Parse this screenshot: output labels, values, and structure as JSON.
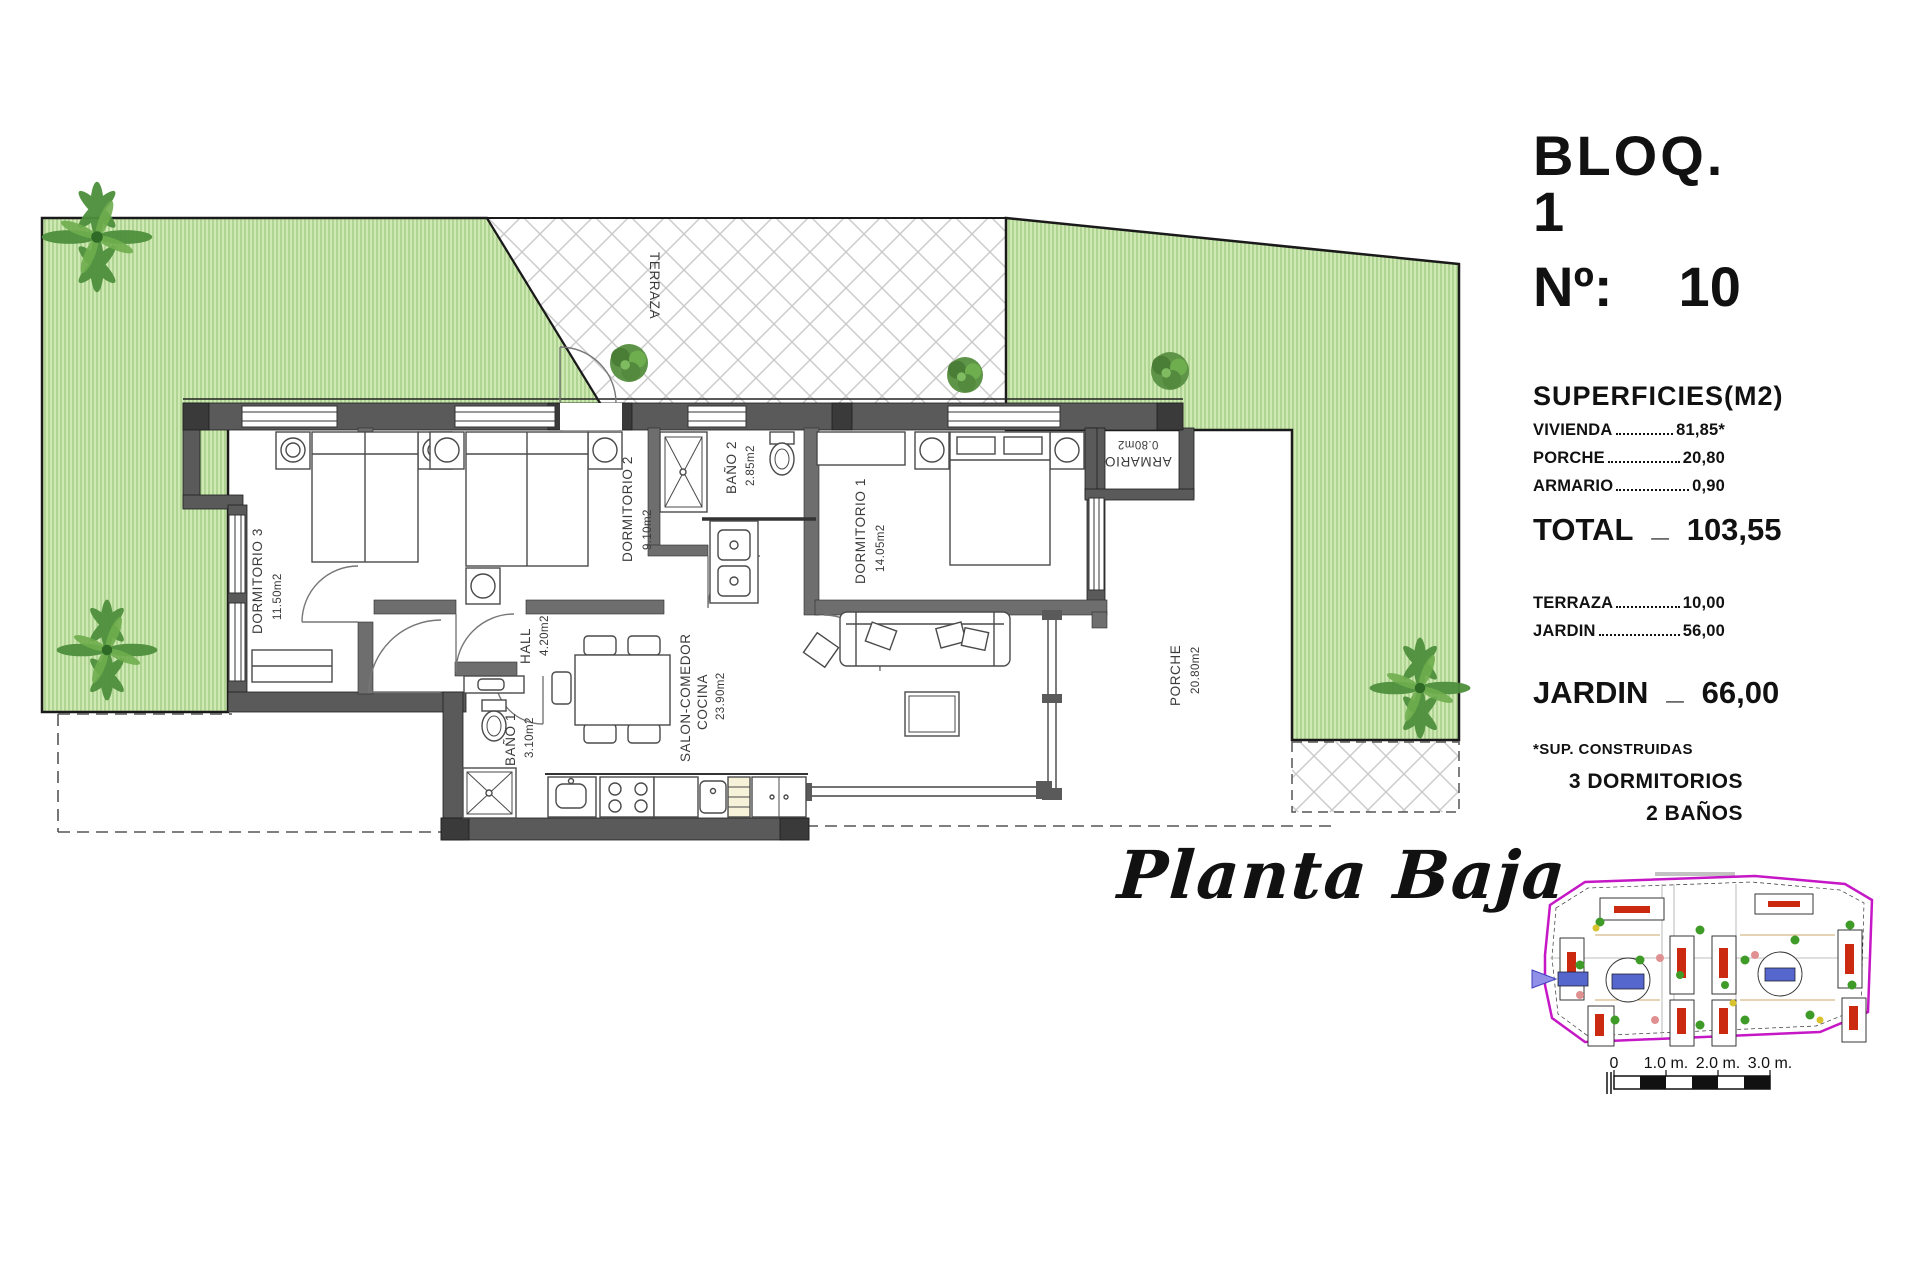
{
  "header": {
    "block_title": "BLOQ. 1",
    "unit_prefix": "Nº:",
    "unit_number": "10"
  },
  "superficies": {
    "title": "SUPERFICIES(M2)",
    "rows": [
      {
        "name": "VIVIENDA",
        "value": "81,85*"
      },
      {
        "name": "PORCHE",
        "value": "20,80"
      },
      {
        "name": "ARMARIO",
        "value": "0,90"
      }
    ],
    "total": {
      "label": "TOTAL",
      "separator": "_",
      "value": "103,55"
    },
    "outdoor_rows": [
      {
        "name": "TERRAZA",
        "value": "10,00"
      },
      {
        "name": "JARDIN",
        "value": "56,00"
      }
    ],
    "jardin_total": {
      "label": "JARDIN",
      "separator": "_",
      "value": "66,00"
    },
    "footnote": "*SUP. CONSTRUIDAS",
    "features": {
      "bedrooms": "3 DORMITORIOS",
      "bathrooms": "2 BAÑOS"
    }
  },
  "plan": {
    "title": "Planta Baja",
    "rooms": {
      "terraza": {
        "name": "TERRAZA",
        "area": ""
      },
      "dormitorio3": {
        "name": "DORMITORIO 3",
        "area": "11.50m2"
      },
      "dormitorio2": {
        "name": "DORMITORIO 2",
        "area": "9.10m2"
      },
      "bano2": {
        "name": "BAÑO 2",
        "area": "2.85m2"
      },
      "dormitorio1": {
        "name": "DORMITORIO 1",
        "area": "14.05m2"
      },
      "armario": {
        "name": "ARMARIO",
        "area": "0.80m2"
      },
      "hall": {
        "name": "HALL",
        "area": "4.20m2"
      },
      "bano1": {
        "name": "BAÑO 1",
        "area": "3.10m2"
      },
      "salon": {
        "name_line1": "SALON-COMEDOR",
        "name_line2": "COCINA",
        "area": "23.90m2"
      },
      "porche": {
        "name": "PORCHE",
        "area": "20.80m2"
      }
    }
  },
  "site_plan": {
    "scale_labels": [
      "0",
      "1.0 m.",
      "2.0 m.",
      "3.0 m."
    ]
  },
  "colors": {
    "grass": "#cfe9b2",
    "grass_stripe": "#8fbf77",
    "hatch_gray": "#c9c9c9",
    "wall_gray": "#5a5a5a",
    "boundary_magenta": "#c617c6",
    "pool_blue": "#5566cc",
    "tree_green": "#3f9b28",
    "label_red": "#cc2a10"
  }
}
